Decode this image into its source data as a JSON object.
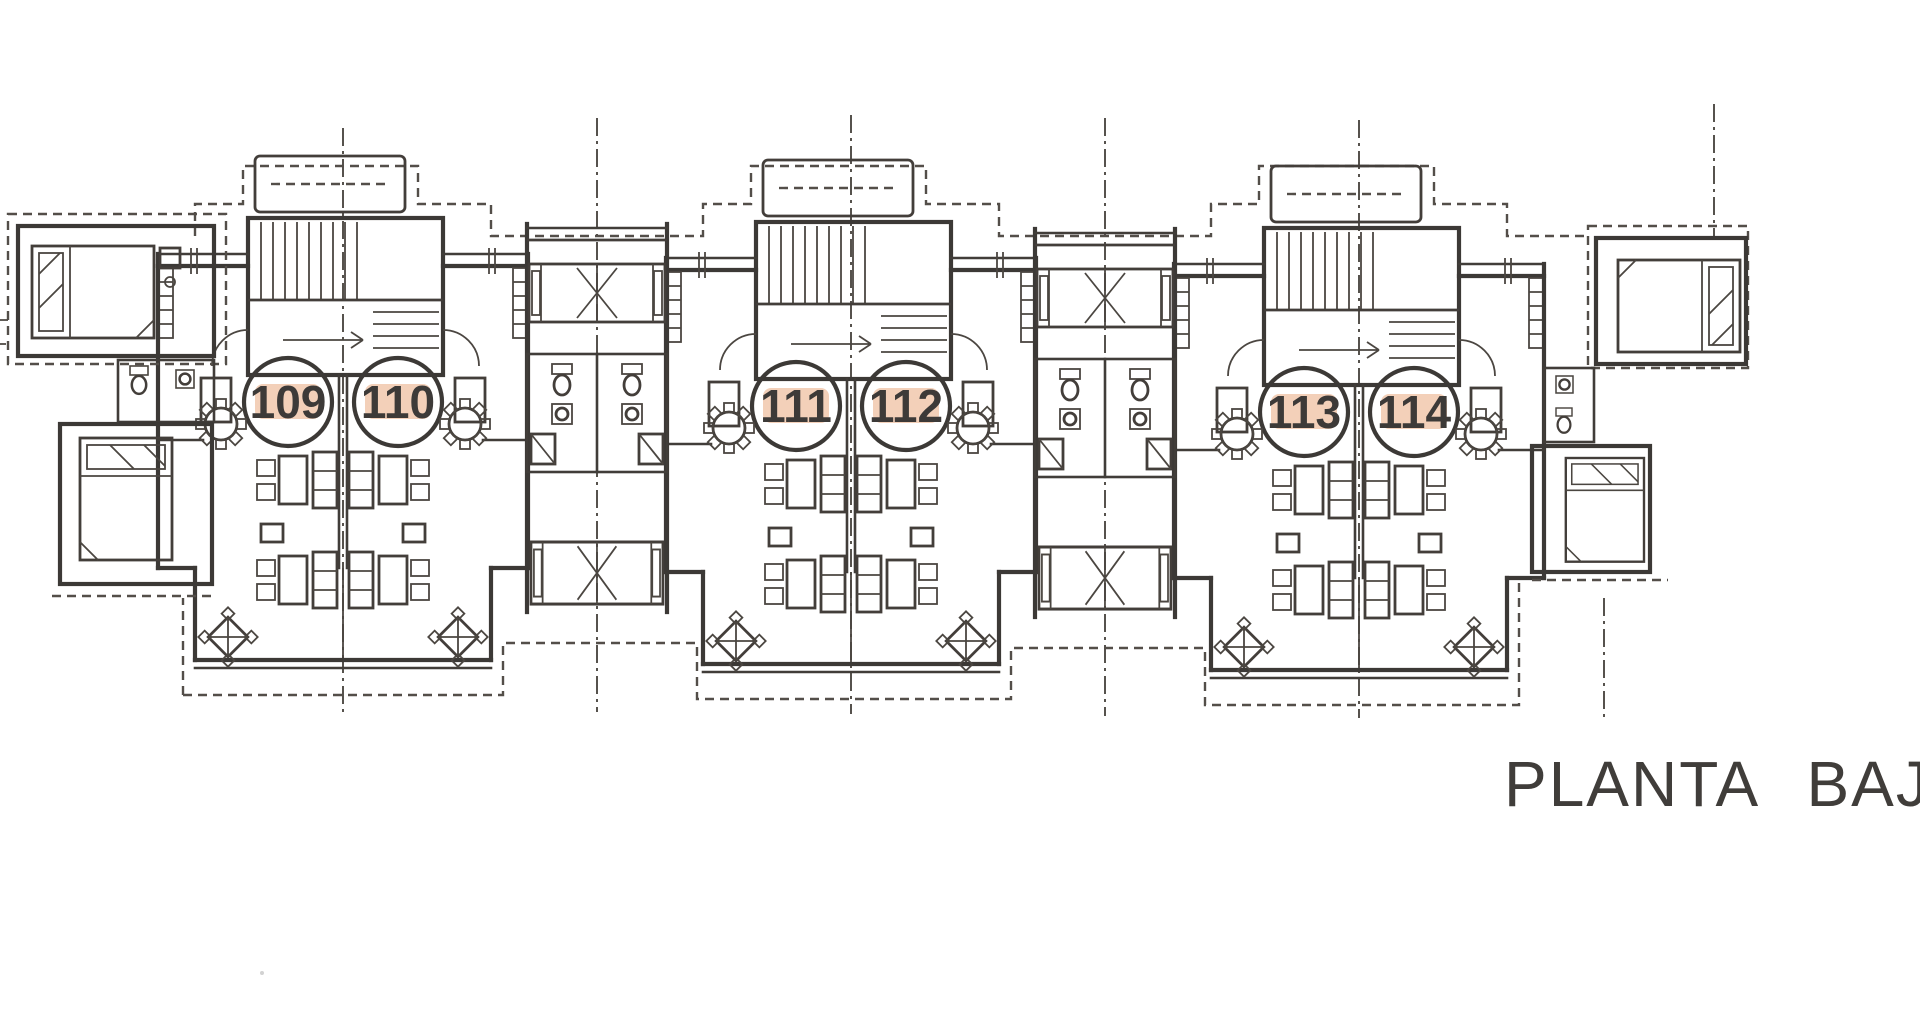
{
  "title": {
    "text": "PLANTA BAJ"
  },
  "units": [
    {
      "label": "109"
    },
    {
      "label": "110"
    },
    {
      "label": "111"
    },
    {
      "label": "112"
    },
    {
      "label": "113"
    },
    {
      "label": "114"
    }
  ],
  "drawing": {
    "type": "architectural floor plan, scanned line drawing",
    "line_color": "#2e2a27",
    "unit_highlight_color": "#f3cdb4",
    "digit_color": "#3d3a38",
    "background_color": "#ffffff",
    "symbols": [
      "staircase",
      "balcony",
      "double-bed",
      "round-table-with-chairs",
      "dining-table-with-chairs",
      "terrace-table",
      "toilet",
      "sink",
      "centerline",
      "site-boundary-dashed"
    ]
  }
}
